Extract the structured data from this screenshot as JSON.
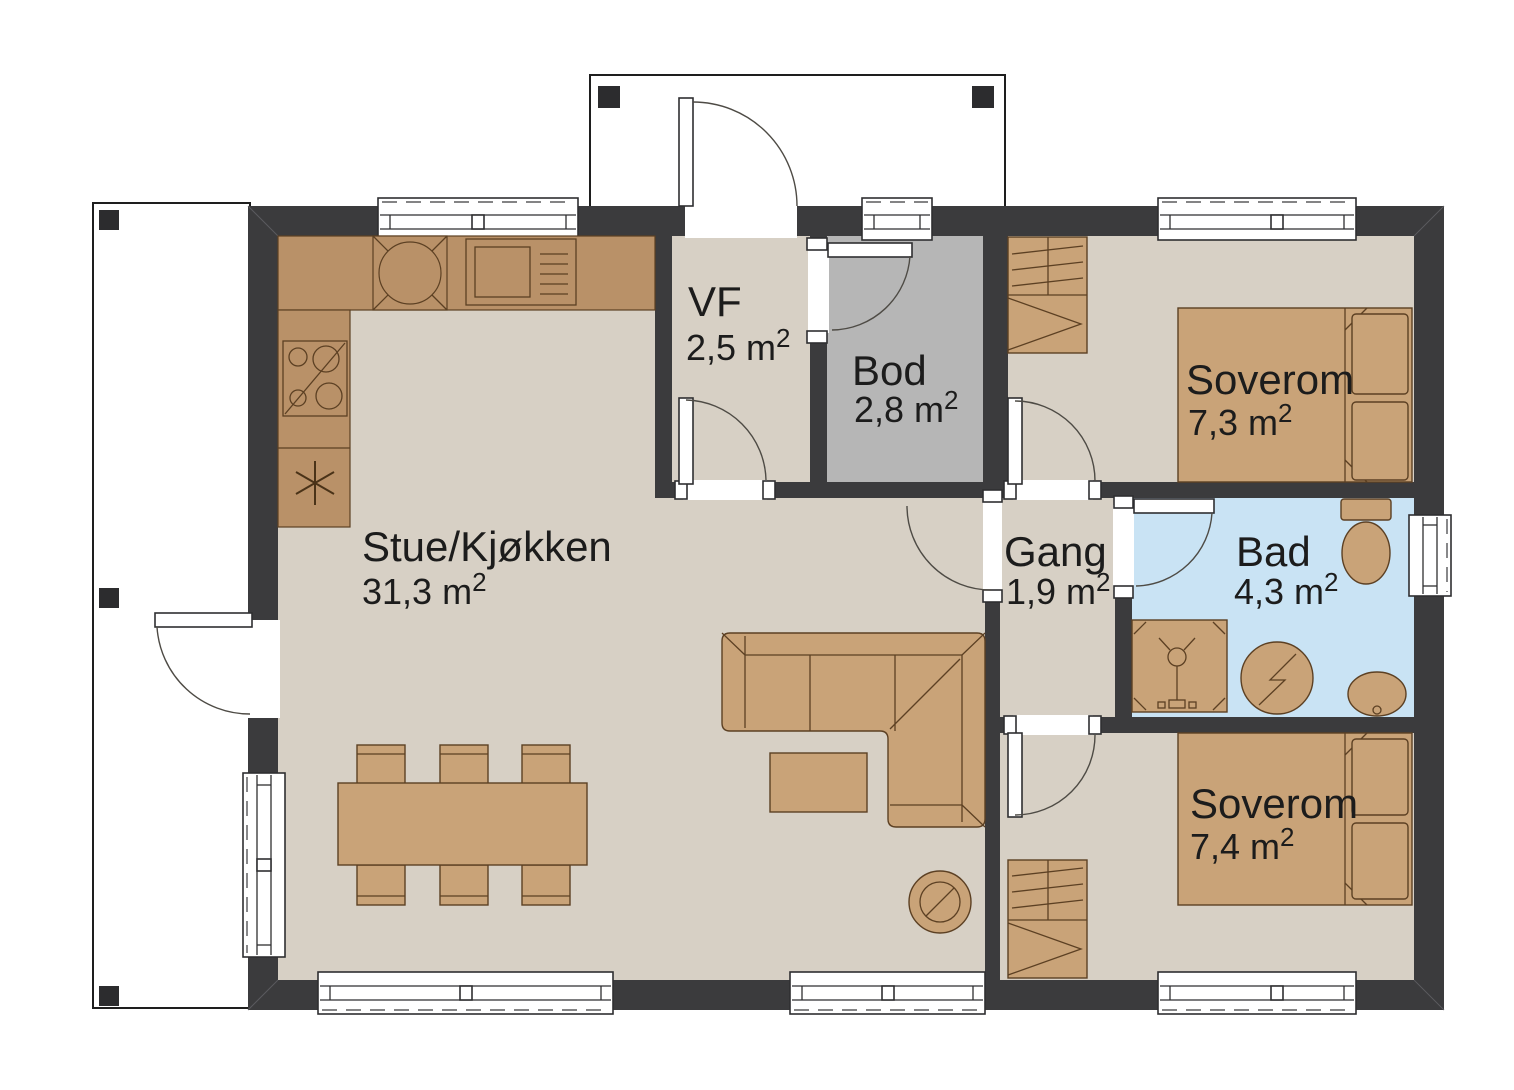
{
  "colors": {
    "wall": "#3b3b3d",
    "floor": "#d7d0c5",
    "floor_bod": "#b6b6b6",
    "floor_bad": "#c9e3f4",
    "furniture": "#c9a378",
    "counter": "#b99168",
    "furniture_outline": "#5c4023",
    "text": "#1c1c1c"
  },
  "rooms": [
    {
      "id": "stue-kjokken",
      "name": "Stue/Kjøkken",
      "area": "31,3 m",
      "area_exponent": "2"
    },
    {
      "id": "vf",
      "name": "VF",
      "area": "2,5 m",
      "area_exponent": "2"
    },
    {
      "id": "bod",
      "name": "Bod",
      "area": "2,8 m",
      "area_exponent": "2"
    },
    {
      "id": "gang",
      "name": "Gang",
      "area": "1,9 m",
      "area_exponent": "2"
    },
    {
      "id": "bad",
      "name": "Bad",
      "area": "4,3 m",
      "area_exponent": "2"
    },
    {
      "id": "soverom-1",
      "name": "Soverom",
      "area": "7,3 m",
      "area_exponent": "2"
    },
    {
      "id": "soverom-2",
      "name": "Soverom",
      "area": "7,4 m",
      "area_exponent": "2"
    }
  ],
  "symbols": {
    "fridge_freezer": "snowflake-asterisk",
    "kitchen_sink": "circle-in-crossed-box",
    "stove": "square-with-vent-lines",
    "cooktop": "four-burner-circles",
    "wood_stove": "circle-with-slash",
    "shower": "square-with-shower-head",
    "washing_machine": "circle-with-zigzag",
    "toilet": "tank-and-bowl",
    "wash_basin": "oval-with-drain"
  }
}
